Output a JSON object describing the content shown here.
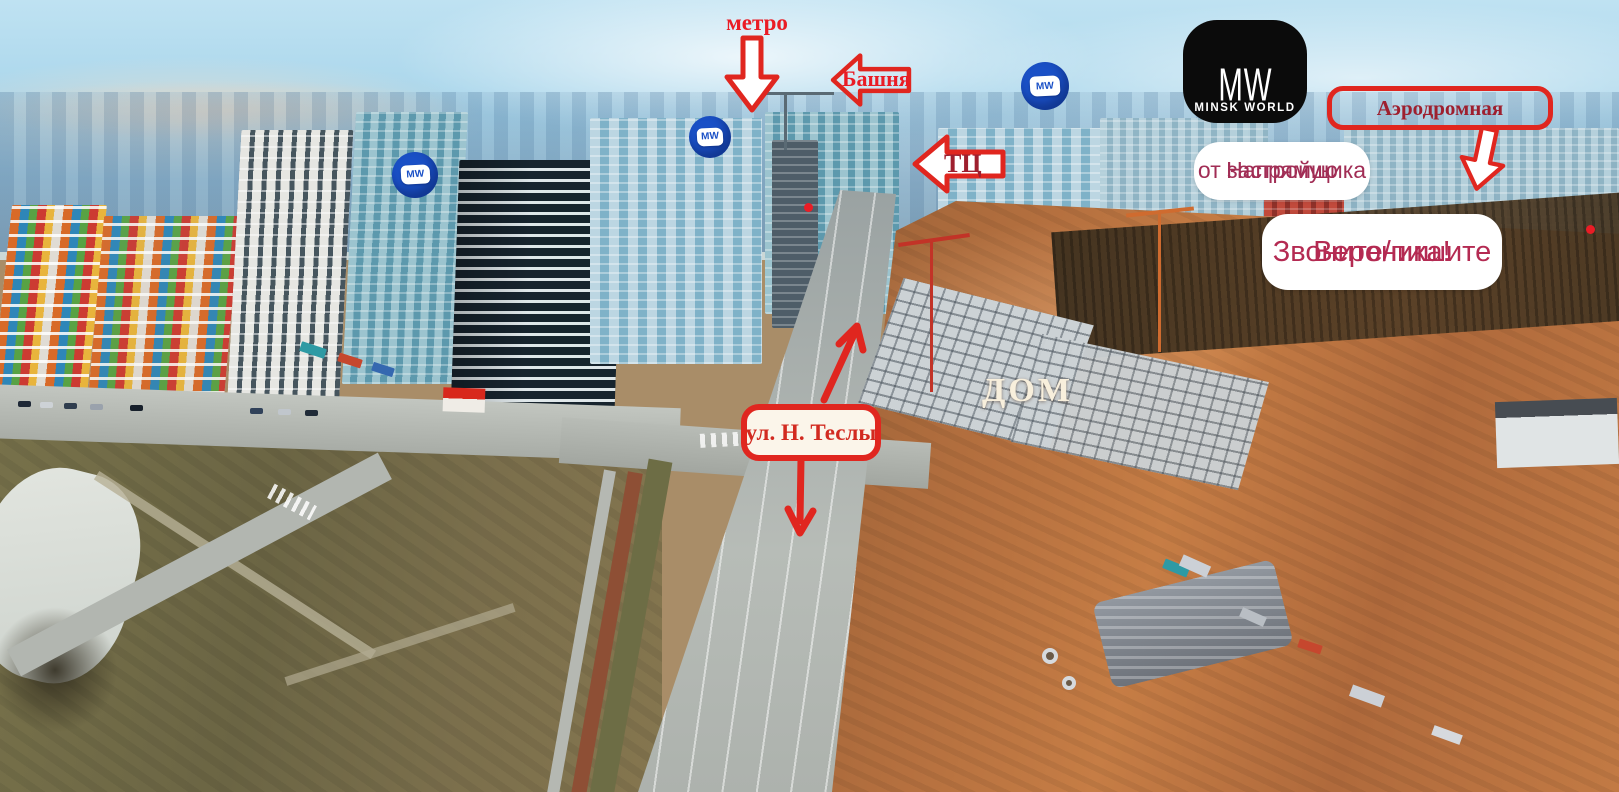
{
  "colors": {
    "annotation_red": "#e0261f",
    "bright_text_red": "#ea1c25",
    "dark_label_red": "#9e1f2e",
    "maroon_text": "#a12d55",
    "crimson_text": "#b42a52",
    "street_text_red": "#d22a20",
    "marker_blue": "#1a50c6",
    "logo_black": "#0b0b0b",
    "house_text": "#f8efdc"
  },
  "annotations": {
    "metro": {
      "label": "метро"
    },
    "tower": {
      "label": "Башня"
    },
    "mall": {
      "label": "ТЦ"
    },
    "aerodromnaya": {
      "label": "Аэродромная"
    },
    "developer": {
      "line1": "Напрямую",
      "line2": "от застройщика"
    },
    "contact": {
      "line1": "Звоните/пишите",
      "line2": "Вероника!"
    },
    "house": {
      "label": "ДОМ"
    },
    "street": {
      "label": "ул. Н. Теслы"
    }
  },
  "logo": {
    "monogram": "MW",
    "name": "MINSK WORLD"
  },
  "marker": {
    "label": "MW"
  }
}
